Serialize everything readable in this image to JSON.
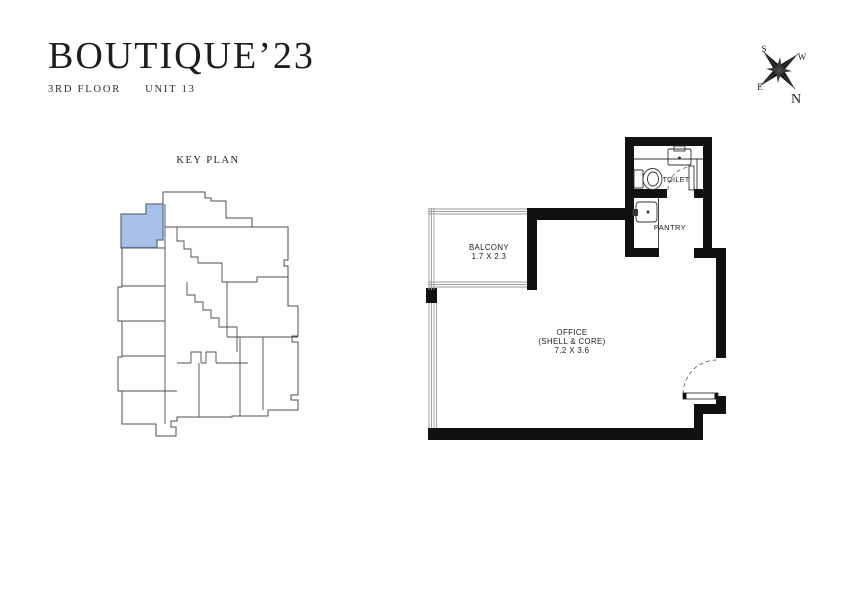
{
  "brand": {
    "title": "BOUTIQUE’23",
    "floor": "3RD FLOOR",
    "unit": "UNIT 13"
  },
  "key_plan": {
    "label": "KEY PLAN",
    "highlight_color": "#a6c0e8",
    "highlight_outline_color": "#5f6f93",
    "outline_color": "#4d4d4d"
  },
  "compass": {
    "north": "N",
    "south": "S",
    "east": "E",
    "west": "W"
  },
  "floor_plan": {
    "wall_color": "#111111",
    "balcony": {
      "label": "BALCONY",
      "dims": "1.7 X 2.3"
    },
    "office": {
      "label": "OFFICE",
      "sublabel": "(SHELL & CORE)",
      "dims": "7.2 X 3.6"
    },
    "toilet": {
      "label": "TOILET"
    },
    "pantry": {
      "label": "PANTRY"
    }
  }
}
